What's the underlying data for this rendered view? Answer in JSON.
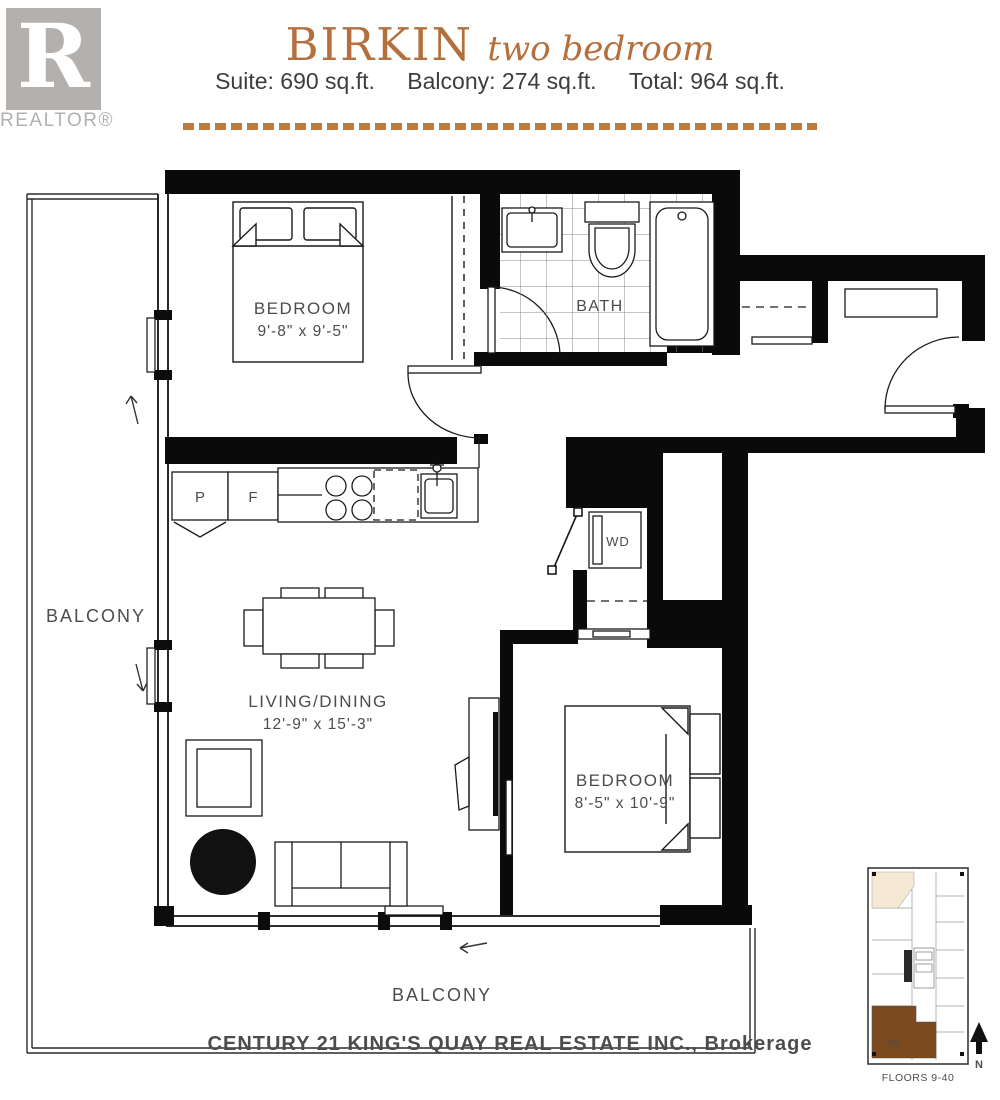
{
  "logo": {
    "letter": "R",
    "label": "REALTOR®"
  },
  "header": {
    "plan_name": "BIRKIN",
    "plan_type": "two bedroom",
    "suite": "Suite: 690 sq.ft.",
    "balcony": "Balcony: 274 sq.ft.",
    "total": "Total: 964 sq.ft."
  },
  "plan": {
    "bedroom1": {
      "name": "BEDROOM",
      "dims": "9'-8\" x 9'-5\""
    },
    "bath": {
      "name": "BATH"
    },
    "living": {
      "name": "LIVING/DINING",
      "dims": "12'-9\" x 15'-3\""
    },
    "bedroom2": {
      "name": "BEDROOM",
      "dims": "8'-5\" x 10'-9\""
    },
    "balcony_left": "BALCONY",
    "balcony_bottom": "BALCONY",
    "laundry": "WD",
    "pantry": "P",
    "fridge": "F"
  },
  "watermark": "CENTURY 21 KING'S QUAY REAL ESTATE INC., Brokerage",
  "keyplan": {
    "unit": "05",
    "floors": "FLOORS 9-40",
    "north": "N"
  },
  "colors": {
    "accent": "#b46f3c",
    "keyplan_unit": "#7b4a1e"
  }
}
